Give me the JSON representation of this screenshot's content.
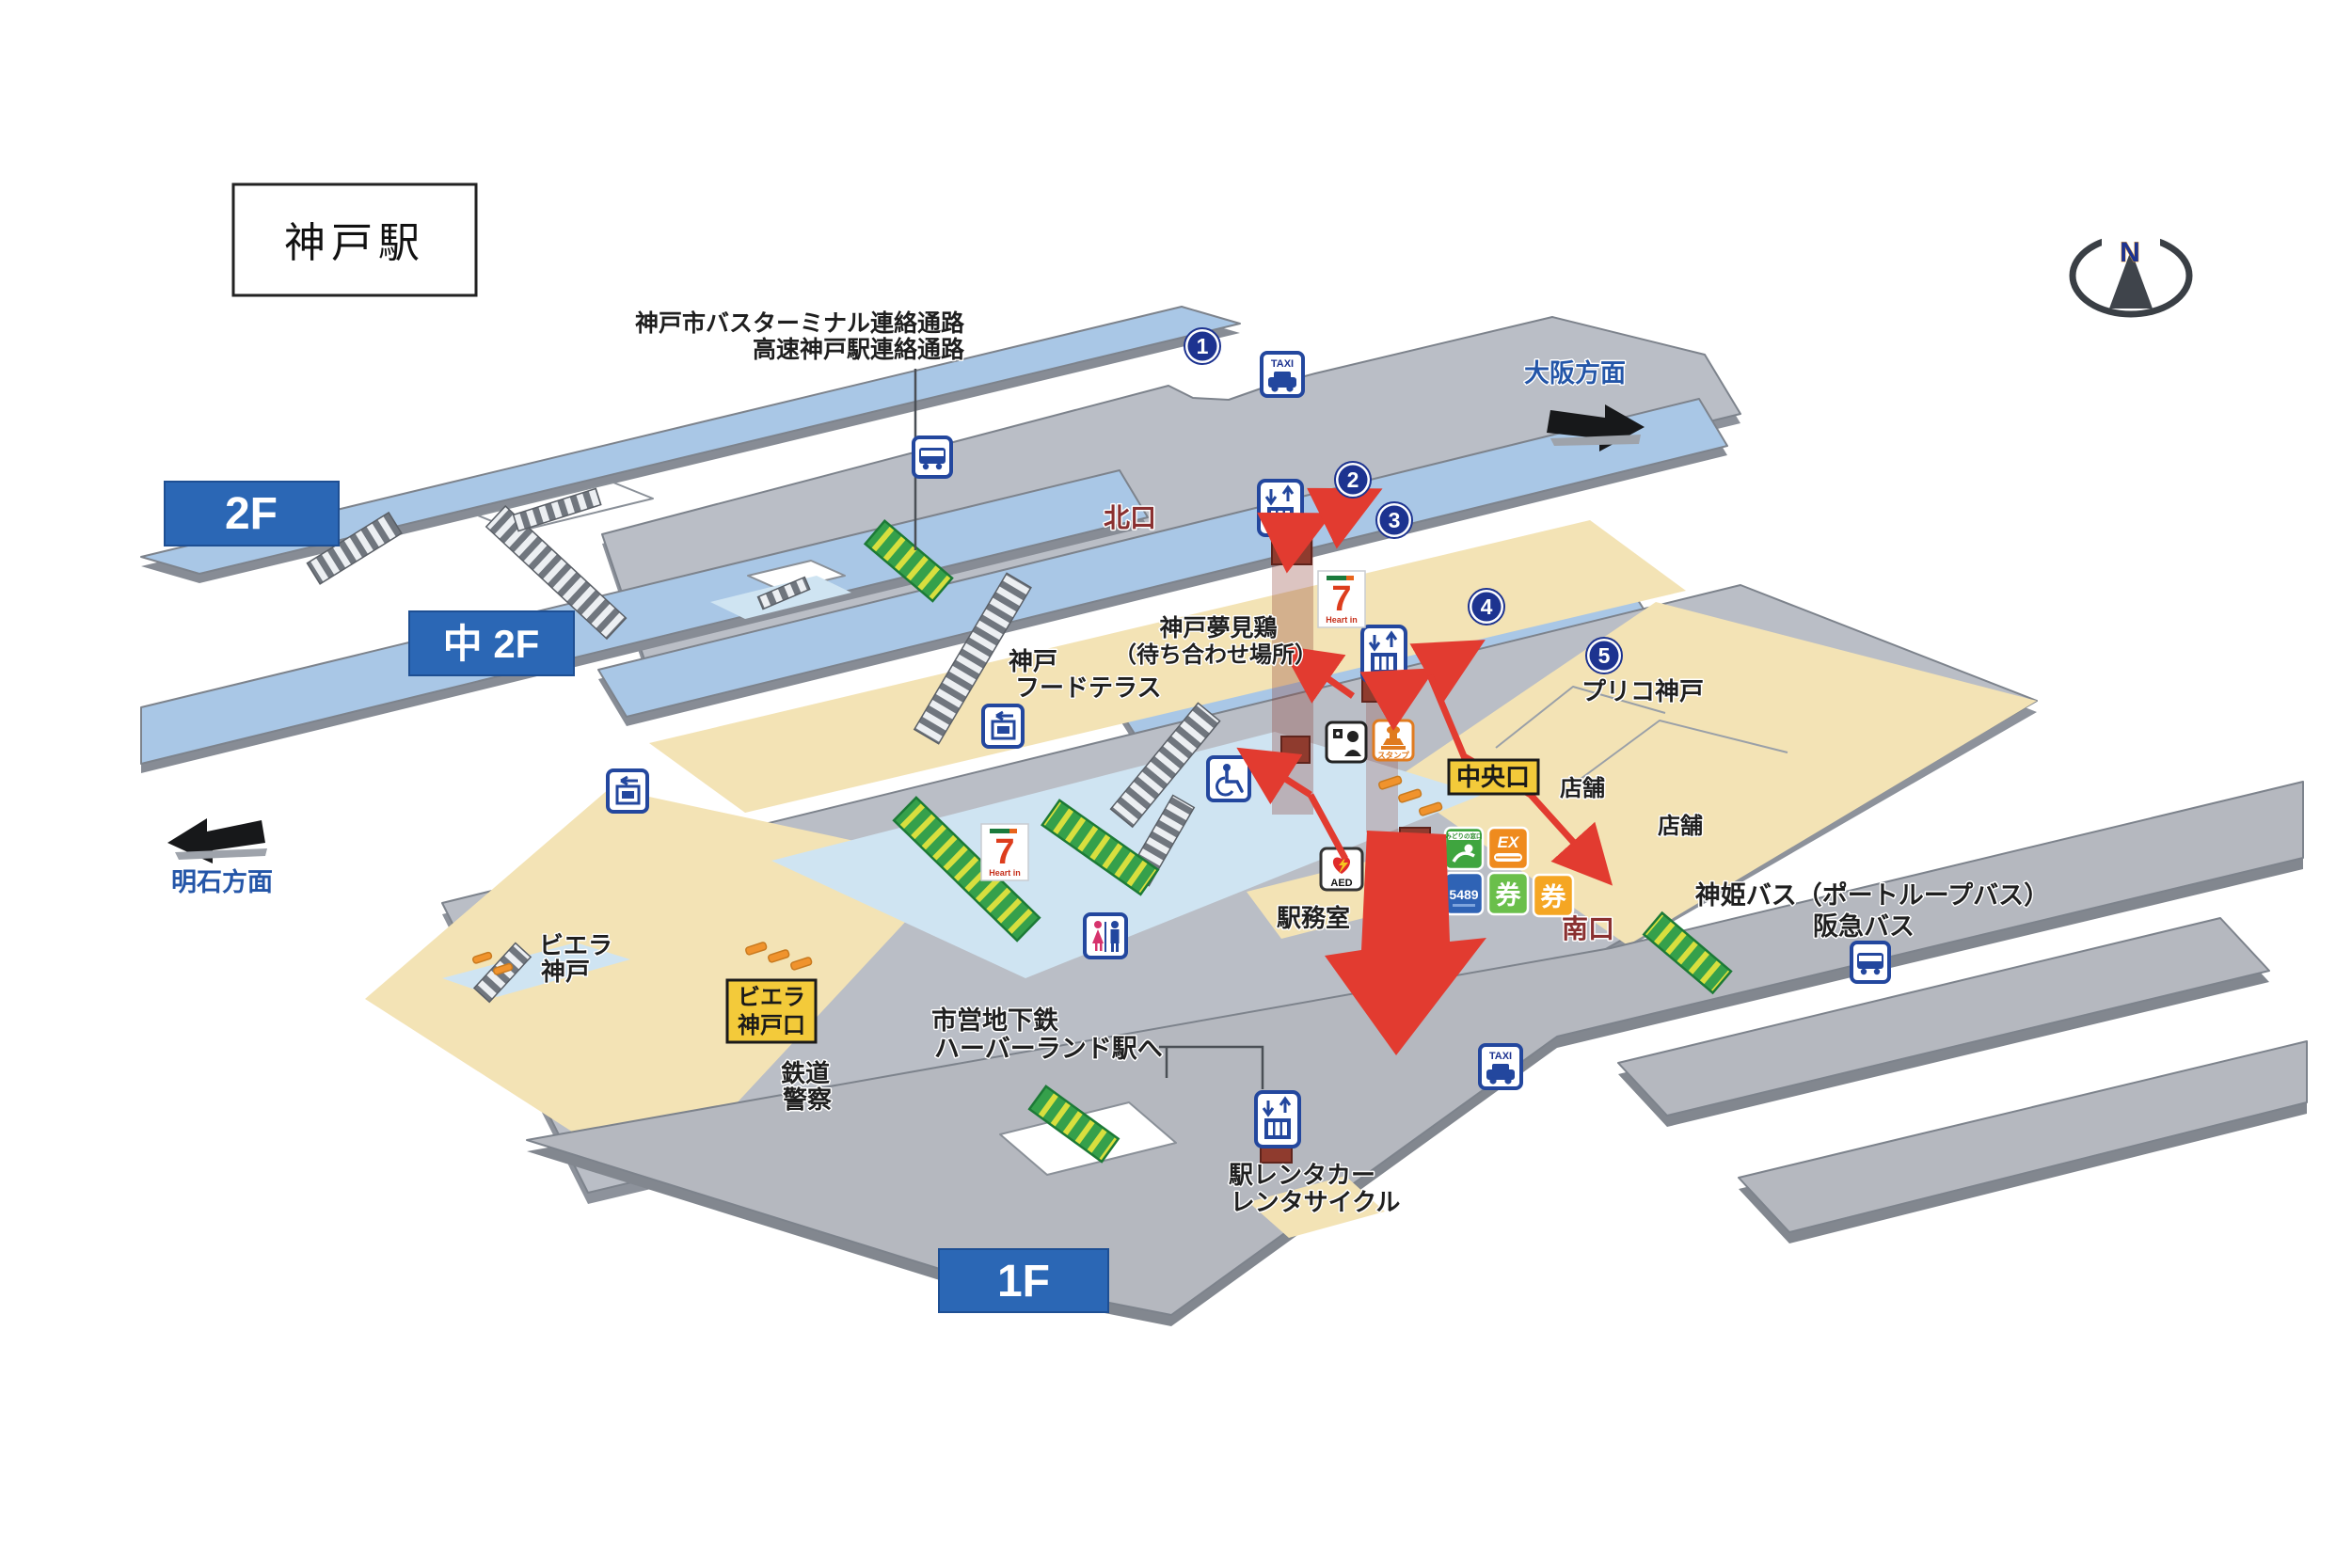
{
  "title": "神戸駅",
  "compass_label": "N",
  "floors": {
    "f2": "2F",
    "m2": "中 2F",
    "f1": "1F"
  },
  "directions": {
    "osaka": "大阪方面",
    "akashi": "明石方面"
  },
  "exits": {
    "north": "北口",
    "central": "中央口",
    "south": "南口",
    "viere_gate_line1": "ビエラ",
    "viere_gate_line2": "神戸口"
  },
  "notes": {
    "bus_link1": "神戸市バスターミナル連絡通路",
    "bus_link2": "高速神戸駅連絡通路",
    "meet1": "神戸夢見鶏",
    "meet2": "（待ち合わせ場所）",
    "food1": "神戸",
    "food2": "フードテラス",
    "prico": "プリコ神戸",
    "shop_a": "店舗",
    "shop_b": "店舗",
    "office": "駅務室",
    "shinki": "神姫バス（ポートループバス）",
    "hankyu": "阪急バス",
    "viere1": "ビエラ",
    "viere2": "神戸",
    "police1": "鉄道",
    "police2": "警察",
    "subway1": "市営地下鉄",
    "subway2": "ハーバーランド駅へ",
    "rent1": "駅レンタカー",
    "rent2": "レンタサイクル"
  },
  "points": [
    "1",
    "2",
    "3",
    "4",
    "5"
  ],
  "icon_text": {
    "taxi": "TAXI",
    "aed": "AED",
    "ex": "EX",
    "tel": "5489",
    "ken_green": "券",
    "ken_orange": "券",
    "seven": "7",
    "seven_sub": "Heart in",
    "stamp": "スタンプ",
    "midori_header": "みどりの窓口"
  },
  "colors": {
    "band_blue": "#a9c7e6",
    "deck_grey": "#babec6",
    "beige": "#f3e3b5",
    "pale_blue": "#cfe4f2",
    "accent_red": "#e23b30",
    "navy": "#1d3390",
    "icon_blue": "#23479e",
    "exit_maroon": "#8a3030",
    "label_blue": "#2456a8",
    "box_yellow": "#f3ca3a",
    "gate_orange": "#f0932d",
    "escalator_green": "#2fa353"
  }
}
